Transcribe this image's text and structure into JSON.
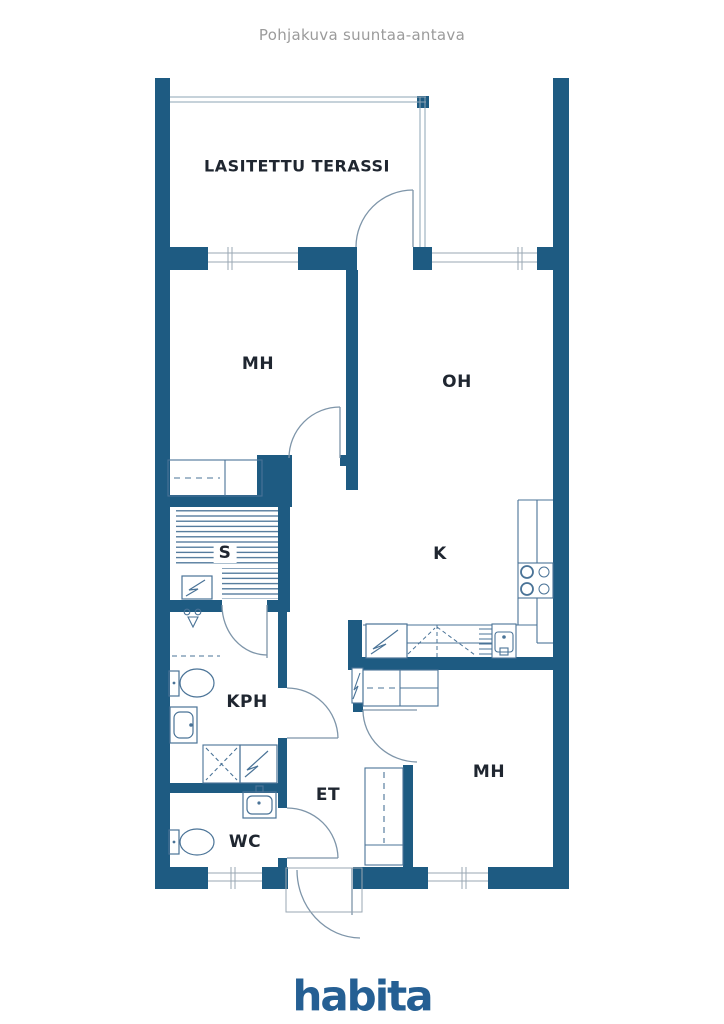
{
  "header": {
    "title": "Pohjakuva suuntaa-antava"
  },
  "branding": {
    "logo_text": "habita",
    "logo_color": "#255f93"
  },
  "colors": {
    "wall": "#1e5b82",
    "fixture_line": "#4a7397",
    "door_line": "#7e95a9",
    "glass_line": "#9aa7b3",
    "label_text": "#1f2630",
    "title_text": "#9b9b9b"
  },
  "floorplan": {
    "rooms": [
      {
        "id": "terrace",
        "label": "LASITETTU TERASSI"
      },
      {
        "id": "bedroom-1",
        "label": "MH"
      },
      {
        "id": "living-room",
        "label": "OH"
      },
      {
        "id": "sauna",
        "label": "S"
      },
      {
        "id": "kitchen",
        "label": "K"
      },
      {
        "id": "bathroom",
        "label": "KPH"
      },
      {
        "id": "hallway",
        "label": "ET"
      },
      {
        "id": "toilet-room",
        "label": "WC"
      },
      {
        "id": "bedroom-2",
        "label": "MH"
      }
    ],
    "symbols": [
      "window",
      "door-swing",
      "sauna-bench",
      "sauna-heater",
      "shower",
      "toilet",
      "washbasin",
      "washing-machine",
      "appliance-reservation",
      "wardrobe",
      "closet",
      "refrigerator",
      "kitchen-sink",
      "dish-rack",
      "stove",
      "tall-cabinet",
      "electrical-panel",
      "entry-canopy"
    ]
  }
}
